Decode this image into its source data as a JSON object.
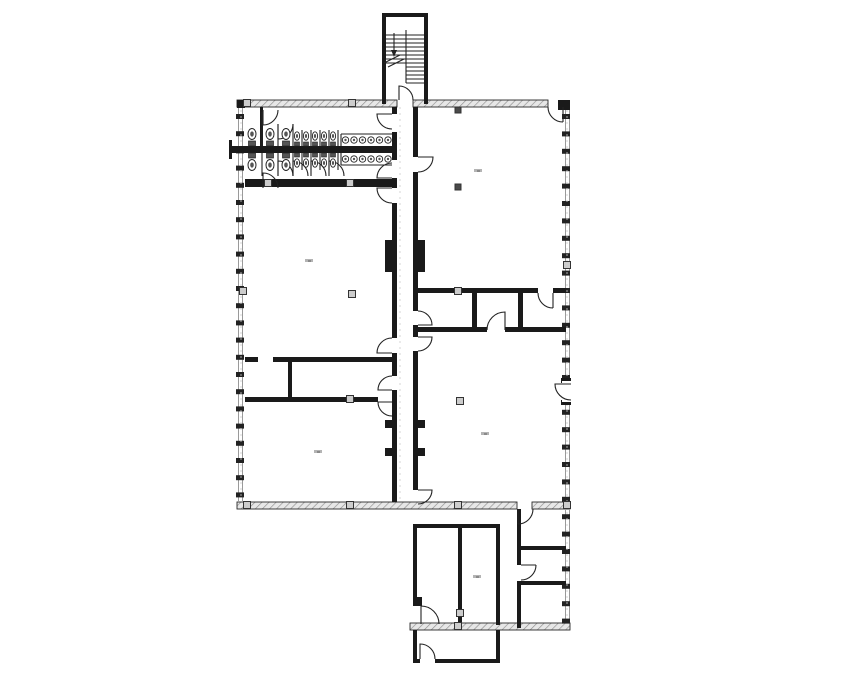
{
  "page": {
    "width": 855,
    "height": 678,
    "background": "#ffffff"
  },
  "palette": {
    "wall": "#1a1a1a",
    "line": "#222222",
    "hatch_bg": "#e7e7e7",
    "hatch_stroke": "#8f8f8f",
    "hatch_edge": "#2a2a2a",
    "window_line": "#9a9a9a",
    "tick": "#222222",
    "column_fill": "#cccccc",
    "column_stroke": "#333333",
    "column_dark": "#4a4a4a",
    "grid": "#cccccc",
    "smudge": "#b4b4b4",
    "smudge_dark": "#8a8a8a",
    "fixture_stroke": "#222222",
    "fixture_fill": "#ffffff",
    "tank": "#555555"
  },
  "floorplan": {
    "hatched_walls": [
      [
        237,
        100,
        160,
        7
      ],
      [
        413,
        100,
        135,
        7
      ],
      [
        237,
        502,
        280,
        7
      ],
      [
        532,
        502,
        38,
        7
      ],
      [
        410,
        623,
        160,
        7
      ]
    ],
    "solid_walls": [
      [
        382,
        13,
        46,
        4
      ],
      [
        382,
        13,
        4,
        91
      ],
      [
        424,
        13,
        4,
        91
      ],
      [
        237,
        100,
        8,
        8
      ],
      [
        558,
        100,
        12,
        10
      ],
      [
        392,
        107,
        5,
        7
      ],
      [
        392,
        132,
        5,
        28
      ],
      [
        392,
        178,
        5,
        10
      ],
      [
        392,
        203,
        5,
        135
      ],
      [
        392,
        353,
        5,
        23
      ],
      [
        392,
        390,
        5,
        112
      ],
      [
        385,
        240,
        7,
        32
      ],
      [
        385,
        420,
        7,
        8
      ],
      [
        385,
        448,
        7,
        8
      ],
      [
        413,
        107,
        5,
        50
      ],
      [
        413,
        172,
        5,
        139
      ],
      [
        413,
        325,
        5,
        12
      ],
      [
        413,
        351,
        5,
        139
      ],
      [
        418,
        240,
        7,
        32
      ],
      [
        418,
        420,
        7,
        8
      ],
      [
        418,
        448,
        7,
        8
      ],
      [
        245,
        179,
        147,
        8
      ],
      [
        232,
        146,
        160,
        7
      ],
      [
        229,
        140,
        3,
        19
      ],
      [
        260,
        107,
        3,
        39
      ],
      [
        245,
        357,
        13,
        5
      ],
      [
        273,
        357,
        119,
        5
      ],
      [
        288,
        362,
        4,
        35
      ],
      [
        245,
        397,
        133,
        5
      ],
      [
        413,
        288,
        125,
        5
      ],
      [
        553,
        288,
        13,
        5
      ],
      [
        472,
        293,
        5,
        39
      ],
      [
        518,
        293,
        5,
        39
      ],
      [
        413,
        327,
        74,
        5
      ],
      [
        505,
        327,
        61,
        5
      ],
      [
        561,
        378,
        10,
        5
      ],
      [
        561,
        400,
        10,
        5
      ],
      [
        413,
        524,
        87,
        4
      ],
      [
        413,
        524,
        4,
        73
      ],
      [
        413,
        597,
        9,
        9
      ],
      [
        458,
        528,
        4,
        97
      ],
      [
        496,
        524,
        4,
        101
      ],
      [
        517,
        509,
        4,
        56
      ],
      [
        517,
        581,
        4,
        47
      ],
      [
        521,
        546,
        45,
        4
      ],
      [
        521,
        581,
        45,
        4
      ],
      [
        413,
        630,
        4,
        33
      ],
      [
        496,
        630,
        4,
        33
      ],
      [
        413,
        659,
        7,
        4
      ],
      [
        435,
        659,
        65,
        4
      ]
    ],
    "white_rects": [
      [
        562,
        381,
        10,
        21
      ]
    ],
    "thin_lines": [
      [
        386,
        35,
        424,
        35
      ],
      [
        386,
        39,
        424,
        39
      ],
      [
        386,
        43,
        424,
        43
      ],
      [
        386,
        47,
        424,
        47
      ],
      [
        386,
        51,
        424,
        51
      ],
      [
        386,
        55,
        424,
        55
      ],
      [
        386,
        59,
        424,
        59
      ],
      [
        386,
        63,
        424,
        63
      ],
      [
        406,
        67,
        424,
        67
      ],
      [
        406,
        71,
        424,
        71
      ],
      [
        406,
        75,
        424,
        75
      ],
      [
        406,
        79,
        424,
        79
      ],
      [
        406,
        83,
        424,
        83
      ],
      [
        406,
        30,
        406,
        83
      ],
      [
        394,
        33,
        394,
        50
      ],
      [
        384,
        63,
        400,
        55
      ],
      [
        388,
        67,
        404,
        59
      ],
      [
        262,
        112,
        262,
        146
      ],
      [
        278,
        124,
        278,
        146
      ],
      [
        293,
        124,
        293,
        146
      ],
      [
        302,
        130,
        302,
        146
      ],
      [
        311,
        130,
        311,
        146
      ],
      [
        320,
        130,
        320,
        146
      ],
      [
        329,
        130,
        329,
        146
      ],
      [
        338,
        130,
        338,
        146
      ],
      [
        262,
        153,
        262,
        176
      ],
      [
        278,
        153,
        278,
        176
      ],
      [
        293,
        153,
        293,
        176
      ],
      [
        302,
        153,
        302,
        170
      ],
      [
        311,
        153,
        311,
        170
      ],
      [
        320,
        153,
        320,
        170
      ],
      [
        329,
        153,
        329,
        170
      ],
      [
        338,
        153,
        338,
        170
      ],
      [
        341,
        134,
        392,
        134
      ],
      [
        341,
        134,
        341,
        146
      ],
      [
        341,
        165,
        392,
        165
      ],
      [
        341,
        153,
        341,
        165
      ]
    ],
    "dashed_lines": [
      [
        241,
        110,
        241,
        500
      ],
      [
        567,
        110,
        567,
        620
      ],
      [
        400,
        107,
        400,
        500
      ]
    ],
    "door_paths": [
      "M392,114 L377,114 A15,15 0 0 0 392,129",
      "M392,178 L377,178 A15,15 0 0 1 392,163",
      "M392,188 L377,188 A15,15 0 0 0 392,203",
      "M392,353 L377,353 A15,15 0 0 1 392,338",
      "M392,390 L378,390 A14,14 0 0 1 392,376",
      "M392,402 L378,402 A14,14 0 0 0 392,416",
      "M418,157 L433,157 A15,15 0 0 1 418,172",
      "M418,325 L432,325 A14,14 0 0 0 418,311",
      "M418,337 L432,337 A14,14 0 0 1 418,351",
      "M418,490 L432,490 A14,14 0 0 1 418,504",
      "M505,330 L505,312 A18,18 0 0 0 487,330",
      "M553,293 L553,308 M538,293 A15,15 0 0 0 553,308",
      "M263,110 L263,125 A15,15 0 0 0 278,110",
      "M263,188 L263,173 A15,15 0 0 1 278,188",
      "M278,139 L278,124 M293,124 A15,15 0 0 1 278,139",
      "M278,176 L278,161 M293,176 A15,15 0 0 0 278,161",
      "M293,176 L293,161 M308,176 A15,15 0 0 0 293,161",
      "M311,176 L311,161 M326,176 A15,15 0 0 0 311,161",
      "M329,176 L329,161 M344,176 A15,15 0 0 0 329,161",
      "M399,100 L399,86 A14,14 0 0 1 413,100",
      "M563,107 L563,122 M548,107 A15,15 0 0 0 563,122",
      "M518,509 L518,524 M533,509 A15,15 0 0 1 518,524",
      "M521,565 L536,565 M521,580 A15,15 0 0 0 536,565",
      "M421,624 L421,606 A18,18 0 0 1 439,624",
      "M420,659 L420,644 A15,15 0 0 1 435,659",
      "M571,384 L555,384 A16,16 0 0 0 571,400"
    ],
    "window_walls": [
      {
        "x1": 238.5,
        "x2": 242.5,
        "y0": 107,
        "y1": 502,
        "tick_x": 236,
        "tick_y0": 114,
        "tick_step": 17.2,
        "tick_count": 23,
        "tick_w": 8,
        "tick_h": 5
      },
      {
        "x1": 565.5,
        "x2": 569.5,
        "y0": 107,
        "y1": 623,
        "tick_x": 562,
        "tick_y0": 114,
        "tick_step": 17.4,
        "tick_count": 30,
        "tick_w": 8,
        "tick_h": 5
      }
    ],
    "columns": [
      [
        247,
        103
      ],
      [
        352,
        103
      ],
      [
        268,
        183
      ],
      [
        350,
        183
      ],
      [
        243,
        291
      ],
      [
        352,
        294
      ],
      [
        458,
        291
      ],
      [
        460,
        401
      ],
      [
        350,
        399
      ],
      [
        247,
        505
      ],
      [
        350,
        505
      ],
      [
        458,
        505
      ],
      [
        567,
        265
      ],
      [
        567,
        505
      ],
      [
        458,
        626
      ],
      [
        460,
        613
      ]
    ],
    "columns_dark": [
      [
        458,
        110
      ],
      [
        458,
        187
      ]
    ],
    "toilets": {
      "top": {
        "xs": [
          252,
          270,
          286
        ],
        "tank_y": 141,
        "bowl_cy": 134
      },
      "bottom": {
        "xs": [
          252,
          270,
          286
        ],
        "tank_y": 153,
        "bowl_cy": 165
      }
    },
    "urinals": {
      "top": {
        "xs": [
          297,
          306,
          315,
          324,
          333
        ],
        "tank_y": 142,
        "bowl_cy": 136
      },
      "bottom": {
        "xs": [
          297,
          306,
          315,
          324,
          333
        ],
        "tank_y": 153,
        "bowl_cy": 163
      }
    },
    "sinks": {
      "xs": [
        345.5,
        354,
        362.5,
        371,
        379.5,
        388
      ],
      "top_cy": 140,
      "bottom_cy": 159,
      "r": 3.2
    },
    "arrow_polygon": [
      [
        391,
        50
      ],
      [
        397,
        50
      ],
      [
        394,
        57
      ]
    ],
    "label_smudges": [
      [
        309,
        261
      ],
      [
        478,
        171
      ],
      [
        318,
        452
      ],
      [
        485,
        434
      ],
      [
        477,
        577
      ]
    ]
  }
}
